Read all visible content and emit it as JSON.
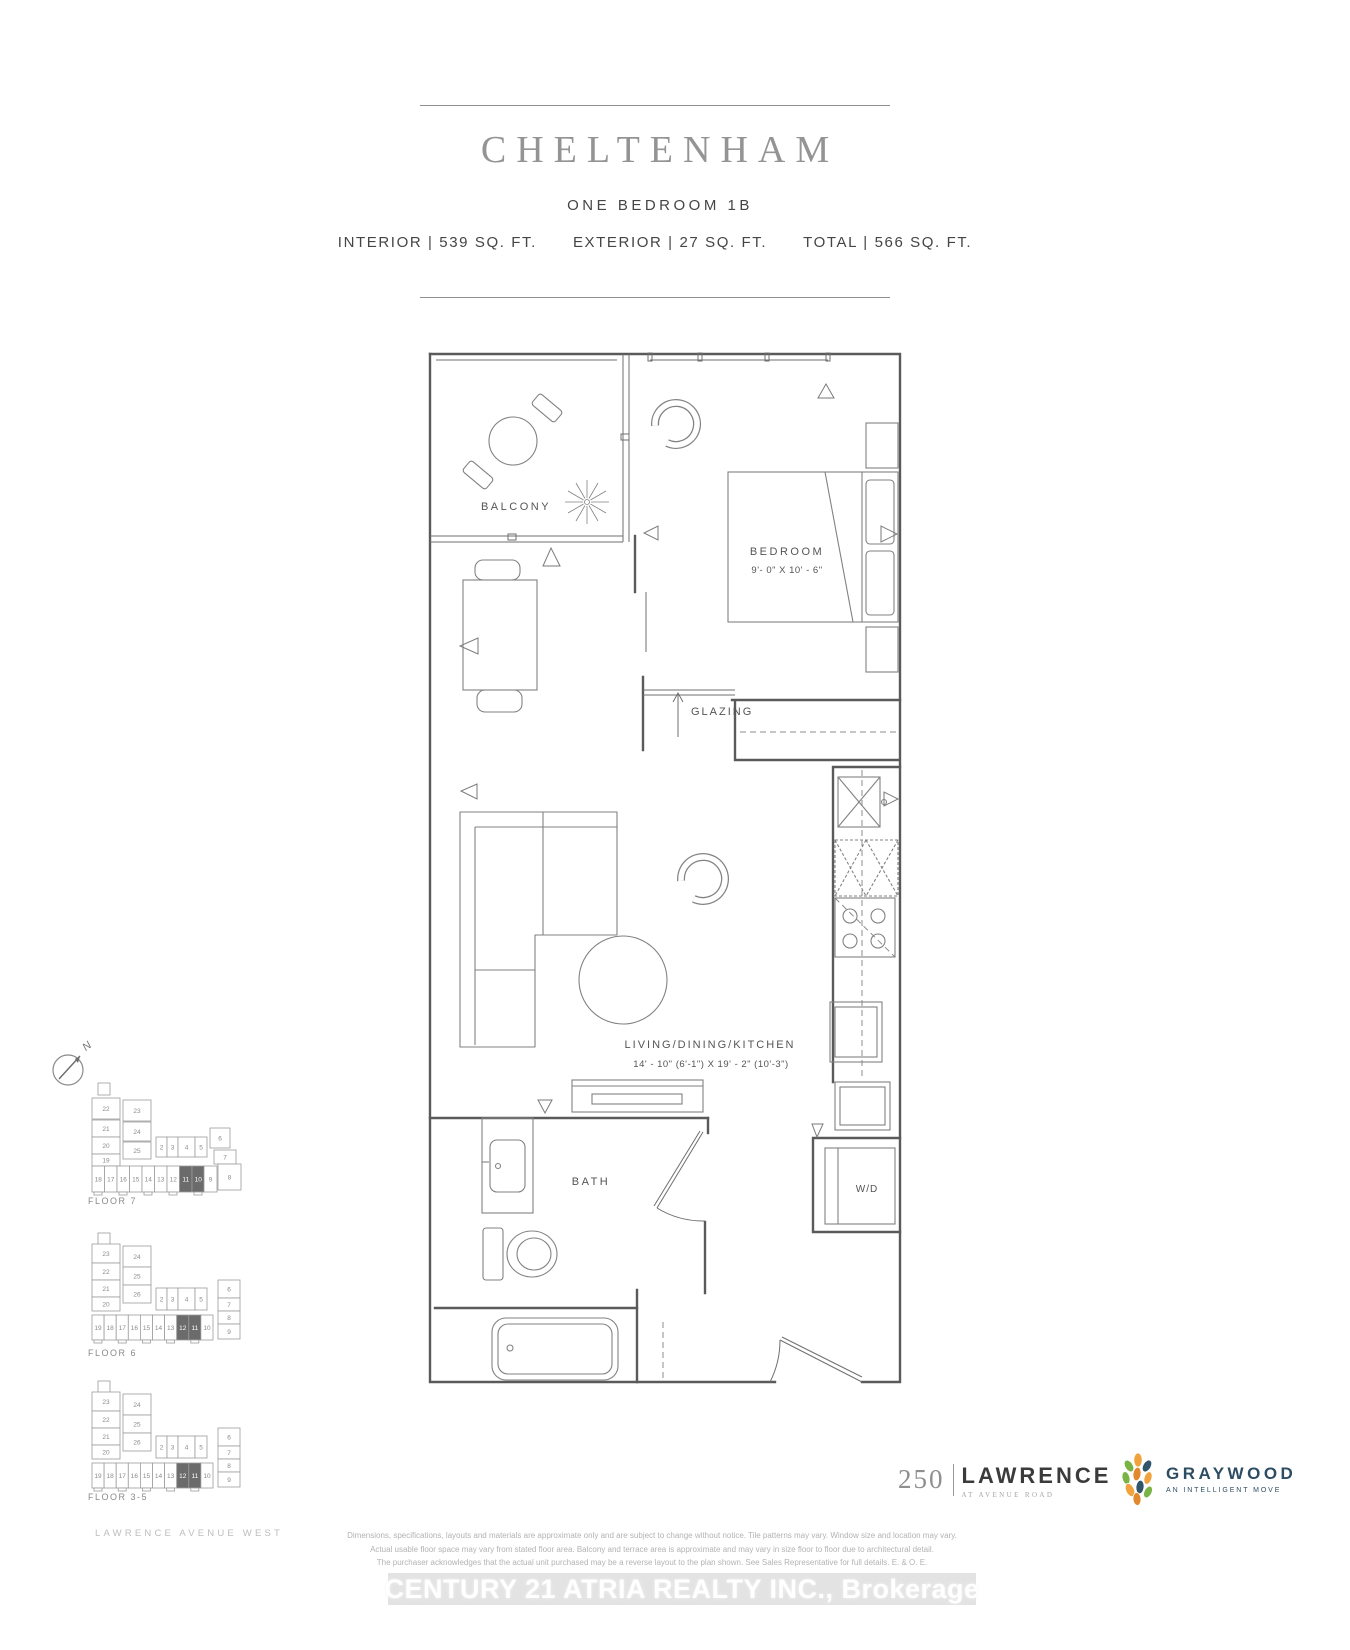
{
  "header": {
    "title": "CHELTENHAM",
    "subtitle": "ONE BEDROOM 1B",
    "stats": [
      "INTERIOR | 539 SQ. FT.",
      "EXTERIOR | 27 SQ. FT.",
      "TOTAL | 566 SQ. FT."
    ]
  },
  "plan": {
    "labels": {
      "balcony": "BALCONY",
      "bedroom": "BEDROOM",
      "bedroom_dims": "9'- 0\" X 10' - 6\"",
      "glazing": "GLAZING",
      "living": "LIVING/DINING/KITCHEN",
      "living_dims": "14' - 10\" (6'-1\") X 19' - 2\" (10'-3\")",
      "bath": "BATH",
      "washer_dryer": "W/D"
    }
  },
  "sidebar": {
    "compass_label": "N",
    "street_label": "LAWRENCE AVENUE WEST",
    "keyplates": [
      {
        "floor_label": "FLOOR 7",
        "shape": "A",
        "left_column": [
          "22",
          "21",
          "20",
          "19"
        ],
        "mid_column": [
          "23",
          "24",
          "25"
        ],
        "mid_row": [
          "2",
          "3",
          "4",
          "5",
          "6",
          "7"
        ],
        "bottom_row": [
          "18",
          "17",
          "16",
          "15",
          "14",
          "13",
          "12",
          "11",
          "10",
          "9",
          "8"
        ],
        "highlighted_units": [
          "11",
          "10"
        ]
      },
      {
        "floor_label": "FLOOR 6",
        "shape": "B",
        "left_column": [
          "23",
          "22",
          "21",
          "20"
        ],
        "mid_column": [
          "24",
          "25",
          "26"
        ],
        "mid_row": [
          "2",
          "3",
          "4",
          "5"
        ],
        "right_column": [
          "6",
          "7",
          "8",
          "9"
        ],
        "bottom_row": [
          "19",
          "18",
          "17",
          "16",
          "15",
          "14",
          "13",
          "12",
          "11",
          "10"
        ],
        "highlighted_units": [
          "12",
          "11"
        ]
      },
      {
        "floor_label": "FLOOR 3-5",
        "shape": "B",
        "left_column": [
          "23",
          "22",
          "21",
          "20"
        ],
        "mid_column": [
          "24",
          "25",
          "26"
        ],
        "mid_row": [
          "2",
          "3",
          "4",
          "5"
        ],
        "right_column": [
          "6",
          "7",
          "8",
          "9"
        ],
        "bottom_row": [
          "19",
          "18",
          "17",
          "16",
          "15",
          "14",
          "13",
          "12",
          "11",
          "10"
        ],
        "highlighted_units": [
          "12",
          "11"
        ]
      }
    ]
  },
  "footer": {
    "disclaimer_lines": [
      "Dimensions, specifications, layouts and materials are approximate only and are subject to change without notice. Tile patterns may vary. Window size and location may vary.",
      "Actual usable floor space may vary from stated floor area. Balcony and terrace area is approximate and may vary in size floor to floor due to architectural detail.",
      "The purchaser acknowledges that the actual unit purchased may be a reverse layout to the plan shown. See Sales Representative for full details. E. & O. E."
    ],
    "logos": {
      "lawrence": {
        "number": "250",
        "name": "LAWRENCE",
        "tagline": "AT AVENUE ROAD"
      },
      "graywood": {
        "name": "GRAYWOOD",
        "tagline": "AN INTELLIGENT MOVE"
      }
    },
    "watermark": "CENTURY 21 ATRIA REALTY INC., Brokerage"
  },
  "colors": {
    "keyplate_highlight": "#6b6b6b",
    "keyplate_stroke": "#9c9c9c",
    "graywood_navy": "#2d4d63",
    "graywood_green": "#79b344",
    "graywood_orange": "#f0a33c",
    "graywood_deep_orange": "#e2892f"
  }
}
